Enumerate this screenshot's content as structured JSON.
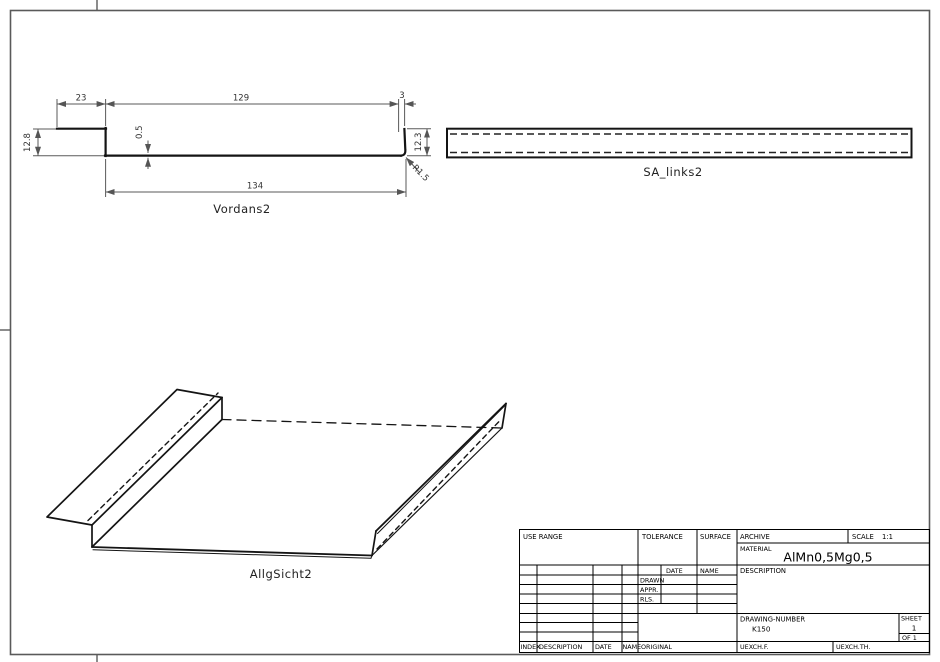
{
  "views": {
    "front": {
      "label": "Vordans2",
      "dims": {
        "top_left": "23",
        "top_mid": "129",
        "top_right": "3",
        "left_height": "12.8",
        "thickness": "0.5",
        "right_height": "12.3",
        "radius": "R1.5",
        "bottom_width": "134"
      }
    },
    "side": {
      "label": "SA_links2"
    },
    "iso": {
      "label": "AllgSicht2"
    }
  },
  "title_block": {
    "use_range": "USE RANGE",
    "tolerance": "TOLERANCE",
    "surface": "SURFACE",
    "archive": "ARCHIVE",
    "scale_label": "SCALE",
    "scale_value": "1:1",
    "material_label": "MATERIAL",
    "material_value": "AlMn0,5Mg0,5",
    "description_label": "DESCRIPTION",
    "approval": {
      "date": "DATE",
      "name": "NAME",
      "drawn": "DRAWN",
      "appr": "APPR.",
      "rls": "RLS."
    },
    "drawing_number_label": "DRAWING-NUMBER",
    "drawing_number_value": "K150",
    "sheet_label": "SHEET",
    "sheet_value": "1",
    "sheet_of": "OF 1",
    "revision": {
      "index": "INDEX",
      "description": "DESCRIPTION",
      "date": "DATE",
      "name": "NAME"
    },
    "original": "ORIGINAL",
    "uexch_f": "UEXCH.F.",
    "uexch_th": "UEXCH.TH."
  }
}
